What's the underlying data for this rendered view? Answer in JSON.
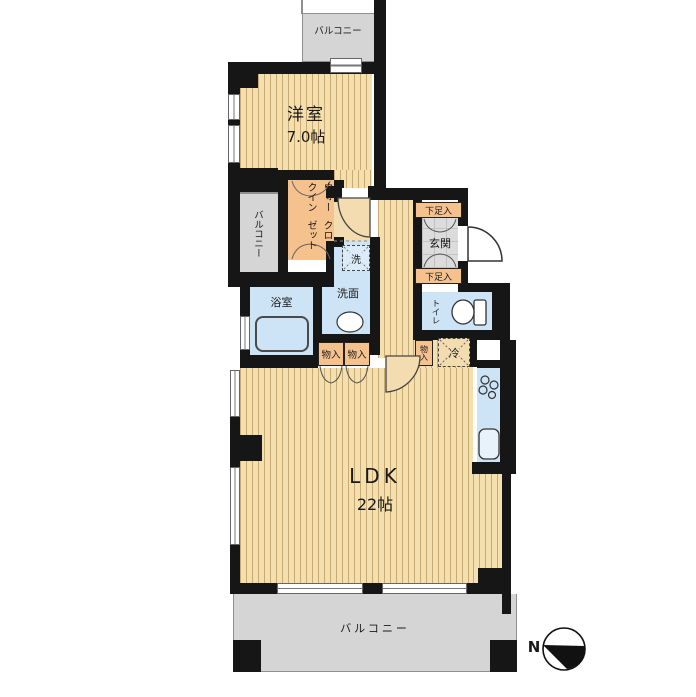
{
  "plan": {
    "rooms": {
      "balcony_top": "バルコニー",
      "balcony_left": "バルコニー",
      "balcony_bottom": "バルコニー",
      "western_room": {
        "name": "洋室",
        "size": "7.0帖"
      },
      "wic": {
        "line1": "ウォークイン",
        "line2": "クローゼット"
      },
      "entrance": {
        "name": "玄関",
        "shoe_upper": "下足入",
        "shoe_lower": "下足入"
      },
      "washer": "洗",
      "washroom": "洗面",
      "bathroom": "浴室",
      "toilet": "トイレ",
      "storage_a": "物入",
      "storage_b": "物入",
      "storage_c": "物入",
      "fridge": "冷",
      "ldk": {
        "name": "LDK",
        "size": "22帖"
      }
    },
    "compass": {
      "label": "N"
    },
    "colors": {
      "wall": "#161616",
      "flooring": "#f4dfae",
      "flooring_stripe": "#a67e42",
      "closet_orange": "#f5c28e",
      "wet_area_blue": "#cde4f6",
      "balcony_gray": "#d5d5d5",
      "entrance_tile": "#dcdcdc"
    }
  }
}
